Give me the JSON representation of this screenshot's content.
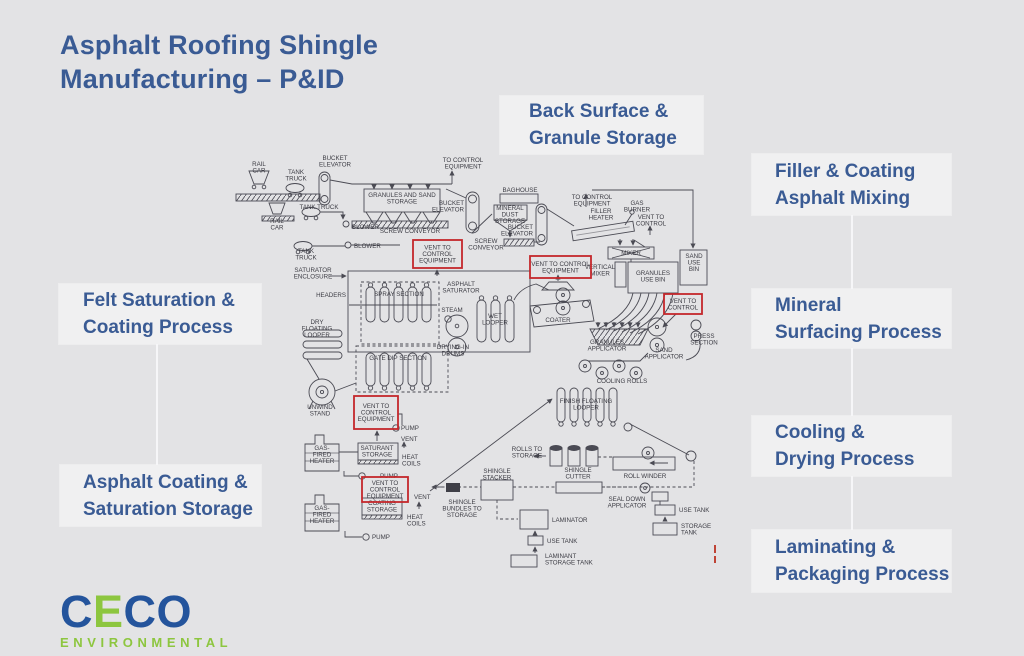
{
  "colors": {
    "background": "#e3e3e5",
    "panel": "#f0f0f1",
    "heading_blue": "#3a5b94",
    "diagram_ink": "#4b4b54",
    "vent_red": "#c4272b",
    "logo_blue": "#24549C",
    "logo_green": "#8DC63F"
  },
  "title": {
    "line1": "Asphalt Roofing Shingle",
    "line2": "Manufacturing – P&ID"
  },
  "callouts": {
    "back": {
      "line1": "Back Surface &",
      "line2": "Granule Storage"
    },
    "filler": {
      "line1": "Filler & Coating",
      "line2": "Asphalt Mixing"
    },
    "felt": {
      "line1": "Felt Saturation &",
      "line2": "Coating Process"
    },
    "mineral": {
      "line1": "Mineral",
      "line2": "Surfacing Process"
    },
    "cooling": {
      "line1": "Cooling &",
      "line2": "Drying Process"
    },
    "asphalt": {
      "line1": "Asphalt Coating &",
      "line2": "Saturation Storage"
    },
    "laminating": {
      "line1": "Laminating &",
      "line2": "Packaging Process"
    }
  },
  "logo": {
    "letters": [
      "C",
      "E",
      "C",
      "O"
    ],
    "sub": "ENVIRONMENTAL"
  },
  "diagram": {
    "labels": [
      {
        "t": "RAIL\nCAR",
        "x": 259,
        "y": 166
      },
      {
        "t": "TANK\nTRUCK",
        "x": 296,
        "y": 174
      },
      {
        "t": "BUCKET\nELEVATOR",
        "x": 335,
        "y": 160
      },
      {
        "t": "TO CONTROL\nEQUIPMENT",
        "x": 463,
        "y": 162
      },
      {
        "t": "GRANULES AND SAND\nSTORAGE",
        "x": 402,
        "y": 197
      },
      {
        "t": "TANK TRUCK",
        "x": 319,
        "y": 209
      },
      {
        "t": "BUCKET\nELEVATOR",
        "x": 464,
        "y": 205,
        "a": "e"
      },
      {
        "t": "RAIL\nCAR",
        "x": 277,
        "y": 223
      },
      {
        "t": "BLOWER",
        "x": 352,
        "y": 229,
        "a": "s"
      },
      {
        "t": "SCREW CONVEYOR",
        "x": 410,
        "y": 233
      },
      {
        "t": "BLOWER",
        "x": 354,
        "y": 248,
        "a": "s"
      },
      {
        "t": "TANK\nTRUCK",
        "x": 306,
        "y": 253
      },
      {
        "t": "SCREW\nCONVEYOR",
        "x": 486,
        "y": 243
      },
      {
        "t": "SATURATOR\nENCLOSURE",
        "x": 313,
        "y": 272
      },
      {
        "t": "BAGHOUSE",
        "x": 520,
        "y": 192
      },
      {
        "t": "MINERAL\nDUST\nSTORAGE",
        "x": 510,
        "y": 210
      },
      {
        "t": "BUCKET\nELEVATOR",
        "x": 533,
        "y": 229,
        "a": "e"
      },
      {
        "t": "TO CONTROL\nEQUIPMENT",
        "x": 592,
        "y": 199
      },
      {
        "t": "FILLER\nHEATER",
        "x": 601,
        "y": 213
      },
      {
        "t": "GAS\nBURNER",
        "x": 637,
        "y": 205
      },
      {
        "t": "VENT TO\nCONTROL",
        "x": 651,
        "y": 219
      },
      {
        "t": "MIXER",
        "x": 631,
        "y": 255
      },
      {
        "t": "VERTICAL\nMIXER",
        "x": 600,
        "y": 269
      },
      {
        "t": "GRANULES\nUSE BIN",
        "x": 653,
        "y": 275
      },
      {
        "t": "SAND\nUSE\nBIN",
        "x": 694,
        "y": 258
      },
      {
        "t": "HEADERS",
        "x": 346,
        "y": 297,
        "a": "e"
      },
      {
        "t": "SPRAY SECTION",
        "x": 399,
        "y": 296
      },
      {
        "t": "ASPHALT\nSATURATOR",
        "x": 461,
        "y": 286
      },
      {
        "t": "STEAM",
        "x": 452,
        "y": 312
      },
      {
        "t": "WET\nLOOPER",
        "x": 495,
        "y": 318
      },
      {
        "t": "DRY\nFLOATING\nLOOPER",
        "x": 317,
        "y": 324
      },
      {
        "t": "GATE DIP SECTION",
        "x": 398,
        "y": 360
      },
      {
        "t": "DRYING-IN\nDRUMS",
        "x": 453,
        "y": 349
      },
      {
        "t": "COATER",
        "x": 558,
        "y": 322
      },
      {
        "t": "GRANULES\nAPPLICATOR",
        "x": 607,
        "y": 344
      },
      {
        "t": "SAND\nAPPLICATOR",
        "x": 664,
        "y": 352
      },
      {
        "t": "PRESS\nSECTION",
        "x": 704,
        "y": 338
      },
      {
        "t": "COOLING ROLLS",
        "x": 622,
        "y": 383
      },
      {
        "t": "FINISH FLOATING\nLOOPER",
        "x": 586,
        "y": 403
      },
      {
        "t": "UNWIND\nSTAND",
        "x": 320,
        "y": 409
      },
      {
        "t": "PUMP",
        "x": 401,
        "y": 430,
        "a": "s"
      },
      {
        "t": "VENT",
        "x": 401,
        "y": 441,
        "a": "s"
      },
      {
        "t": "SATURANT\nSTORAGE",
        "x": 377,
        "y": 450
      },
      {
        "t": "HEAT\nCOILS",
        "x": 402,
        "y": 459,
        "a": "s"
      },
      {
        "t": "GAS-\nFIRED\nHEATER",
        "x": 322,
        "y": 450
      },
      {
        "t": "PUMP",
        "x": 380,
        "y": 478,
        "a": "s"
      },
      {
        "t": "VENT",
        "x": 414,
        "y": 499,
        "a": "s"
      },
      {
        "t": "COATING\nSTORAGE",
        "x": 382,
        "y": 505
      },
      {
        "t": "HEAT\nCOILS",
        "x": 407,
        "y": 519,
        "a": "s"
      },
      {
        "t": "GAS-\nFIRED\nHEATER",
        "x": 322,
        "y": 510
      },
      {
        "t": "PUMP",
        "x": 372,
        "y": 539,
        "a": "s"
      },
      {
        "t": "ROLLS TO\nSTORAGE",
        "x": 527,
        "y": 451
      },
      {
        "t": "SHINGLE\nSTACKER",
        "x": 497,
        "y": 473
      },
      {
        "t": "SHINGLE\nCUTTER",
        "x": 578,
        "y": 472
      },
      {
        "t": "ROLL WINDER",
        "x": 645,
        "y": 478
      },
      {
        "t": "SHINGLE\nBUNDLES TO\nSTORAGE",
        "x": 462,
        "y": 504
      },
      {
        "t": "SEAL DOWN\nAPPLICATOR",
        "x": 627,
        "y": 501
      },
      {
        "t": "USE TANK",
        "x": 679,
        "y": 512,
        "a": "s"
      },
      {
        "t": "STORAGE\nTANK",
        "x": 681,
        "y": 528,
        "a": "s"
      },
      {
        "t": "LAMINATOR",
        "x": 552,
        "y": 522,
        "a": "s"
      },
      {
        "t": "USE TANK",
        "x": 547,
        "y": 543,
        "a": "s"
      },
      {
        "t": "LAMINANT\nSTORAGE TANK",
        "x": 545,
        "y": 558,
        "a": "s"
      }
    ],
    "vents": [
      {
        "x": 413,
        "y": 240,
        "w": 49,
        "h": 28,
        "lines": [
          "VENT TO",
          "CONTROL",
          "EQUIPMENT"
        ]
      },
      {
        "x": 530,
        "y": 256,
        "w": 61,
        "h": 22,
        "lines": [
          "VENT TO CONTROL",
          "EQUIPMENT"
        ]
      },
      {
        "x": 664,
        "y": 294,
        "w": 38,
        "h": 20,
        "lines": [
          "VENT TO",
          "CONTROL"
        ]
      },
      {
        "x": 354,
        "y": 396,
        "w": 44,
        "h": 33,
        "lines": [
          "VENT TO",
          "CONTROL",
          "EQUIPMENT"
        ]
      },
      {
        "x": 362,
        "y": 477,
        "w": 46,
        "h": 25,
        "lines": [
          "VENT TO",
          "CONTROL",
          "EQUIPMENT"
        ]
      }
    ]
  }
}
